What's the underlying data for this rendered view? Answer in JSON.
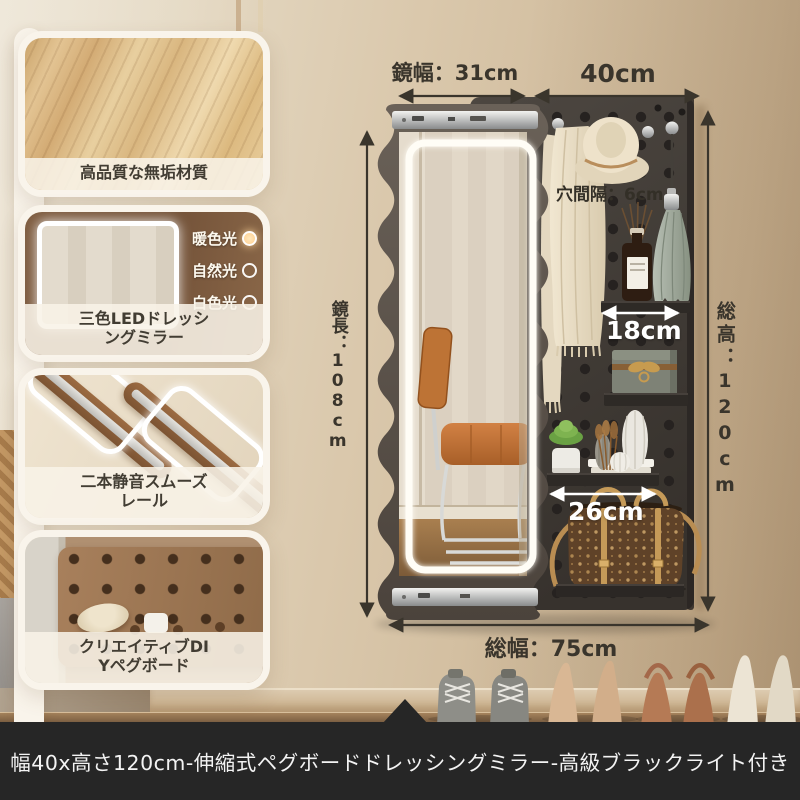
{
  "product": {
    "banner_title": "幅40x高さ120cm-伸縮式ペグボードドレッシングミラー-高級ブラックライト付き"
  },
  "feature_panels": [
    {
      "caption": "高品質な無垢材質"
    },
    {
      "caption": "三色LEDドレッシ\nングミラー",
      "light_modes": [
        "暖色光",
        "自然光",
        "白色光"
      ]
    },
    {
      "caption": "二本静音スムーズ\nレール"
    },
    {
      "caption": "クリエイティブDI\nYペグボード"
    }
  ],
  "dimensions": {
    "mirror_width": "鏡幅：31cm",
    "pegboard_width": "40cm",
    "mirror_height": "鏡長：108cm",
    "total_height": "総高：120cm",
    "hole_spacing": "穴間隔：6cm",
    "shelf_small": "18cm",
    "shelf_large": "26cm",
    "total_width": "総幅：75cm"
  },
  "colors": {
    "wall": "#d9c7ab",
    "pegboard": "#433d38",
    "mirror_frame": "#5b534b",
    "led": "#fffdf6",
    "banner_bg": "#262626",
    "banner_text": "#f3f3f3",
    "annotation": "#3a352c"
  }
}
